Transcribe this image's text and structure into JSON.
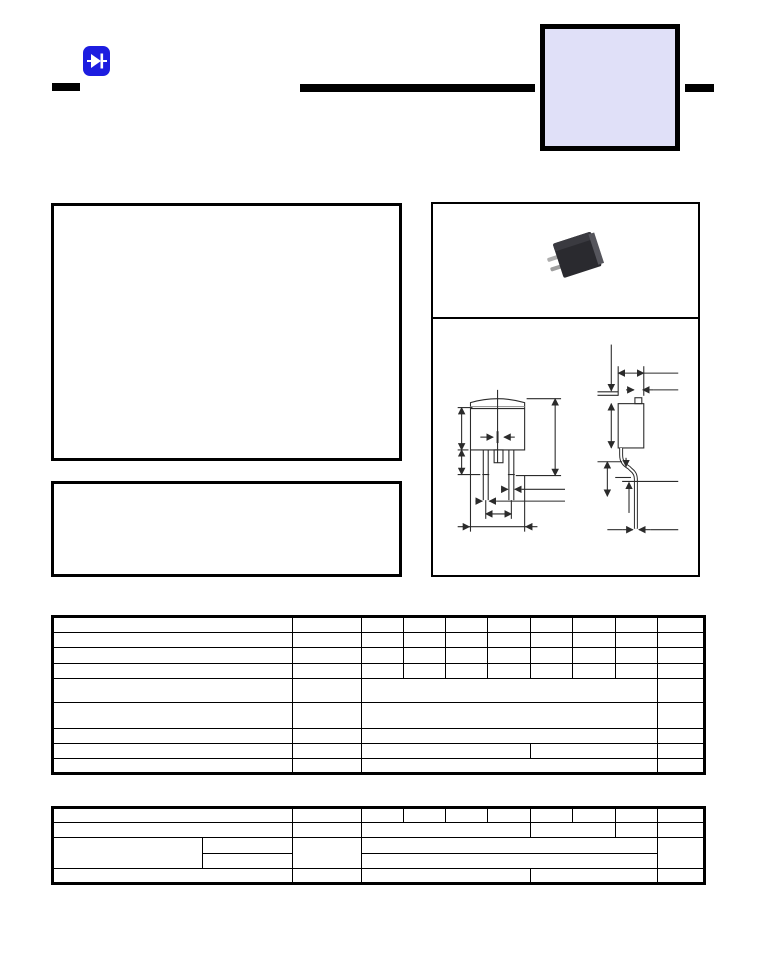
{
  "colors": {
    "page_bg": "#ffffff",
    "ink": "#000000",
    "logo_blue": "#1d1de0",
    "part_box_fill": "#e0e0f8",
    "photo_body": "#26262b",
    "photo_lead": "#b4b4b4",
    "drawing_line": "#2b2b2b"
  },
  "header": {
    "logo_icon": "diode-icon",
    "part_number_box_text": "",
    "left_bar": "",
    "center_rule": "",
    "right_bar": ""
  },
  "features_box": {
    "text": ""
  },
  "description_box": {
    "text": ""
  },
  "package_panel": {
    "photo": "dpak-package-photo",
    "drawing": "package-outline-dimension-drawing"
  },
  "ratings_table": {
    "col_widths": [
      240,
      69,
      42,
      42,
      42,
      43,
      42,
      43,
      42,
      47
    ],
    "rows": [
      {
        "h": 16,
        "cells": [
          {},
          {},
          {},
          {},
          {},
          {},
          {},
          {},
          {},
          {}
        ]
      },
      {
        "h": 15,
        "cells": [
          {},
          {},
          {},
          {},
          {},
          {},
          {},
          {},
          {},
          {}
        ]
      },
      {
        "h": 16,
        "cells": [
          {},
          {},
          {},
          {},
          {},
          {},
          {},
          {},
          {},
          {}
        ]
      },
      {
        "h": 15,
        "cells": [
          {},
          {},
          {},
          {},
          {},
          {},
          {},
          {},
          {},
          {}
        ]
      },
      {
        "h": 24,
        "cells": [
          {},
          {},
          {
            "c": 7
          },
          {}
        ]
      },
      {
        "h": 26,
        "cells": [
          {},
          {},
          {
            "c": 7
          },
          {}
        ]
      },
      {
        "h": 15,
        "cells": [
          {},
          {},
          {
            "c": 7
          },
          {}
        ]
      },
      {
        "h": 15,
        "cells": [
          {},
          {},
          {
            "c": 4
          },
          {
            "c": 3
          },
          {}
        ]
      },
      {
        "h": 15,
        "cells": [
          {},
          {},
          {
            "c": 7
          },
          {}
        ]
      }
    ]
  },
  "characteristics_table": {
    "col_widths": [
      150,
      90,
      69,
      42,
      42,
      42,
      43,
      42,
      43,
      42,
      47
    ],
    "rows": [
      {
        "h": 15,
        "cells": [
          {
            "c": 2
          },
          {},
          {},
          {},
          {},
          {},
          {},
          {},
          {},
          {}
        ]
      },
      {
        "h": 15,
        "cells": [
          {
            "c": 2
          },
          {},
          {
            "c": 4
          },
          {
            "c": 2
          },
          {},
          {}
        ]
      },
      {
        "h": 16,
        "cells": [
          {
            "r": 2
          },
          {},
          {
            "r": 2
          },
          {
            "c": 7
          },
          {
            "r": 2
          }
        ]
      },
      {
        "h": 15,
        "cells": [
          {},
          {
            "c": 7
          }
        ]
      },
      {
        "h": 15,
        "cells": [
          {
            "c": 2
          },
          {},
          {
            "c": 4
          },
          {
            "c": 3
          },
          {}
        ]
      }
    ]
  }
}
